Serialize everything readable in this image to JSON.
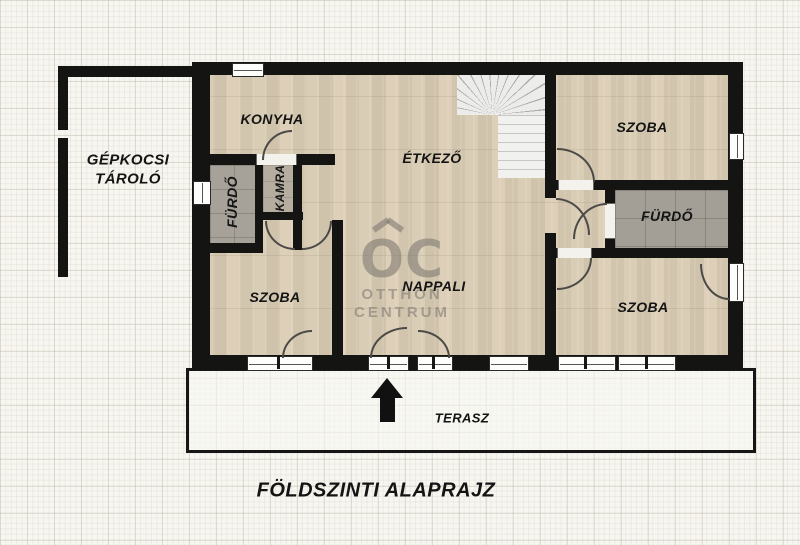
{
  "title": "FÖLDSZINTI ALAPRAJZ",
  "watermark": {
    "logo": "OC",
    "line1": "OTTHON",
    "line2": "CENTRUM"
  },
  "rooms": {
    "garage": {
      "label": "GÉPKOCSI TÁROLÓ"
    },
    "kitchen": {
      "label": "KONYHA"
    },
    "dining": {
      "label": "ÉTKEZŐ"
    },
    "pantry": {
      "label": "KAMRA"
    },
    "bath_left": {
      "label": "FÜRDŐ"
    },
    "bath_right": {
      "label": "FÜRDŐ"
    },
    "room_top_right": {
      "label": "SZOBA"
    },
    "room_bottom_right": {
      "label": "SZOBA"
    },
    "room_bottom_left": {
      "label": "SZOBA"
    },
    "living": {
      "label": "NAPPALI"
    },
    "terrace": {
      "label": "TERASZ"
    }
  },
  "colors": {
    "wall": "#141413",
    "wood_floor": "#d6c9b2",
    "tile_floor": "#a6a199",
    "paper": "#f7f6f1",
    "watermark": "#76736b"
  }
}
